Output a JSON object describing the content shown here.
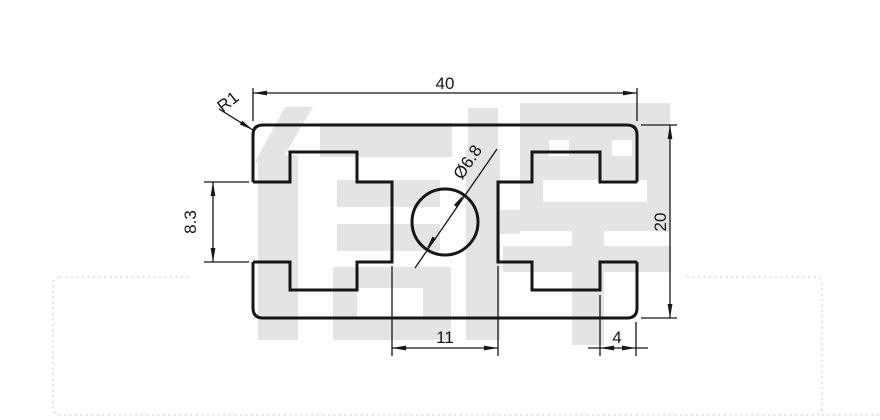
{
  "drawing": {
    "watermark_text": "信牌",
    "dimensions": {
      "overall_width": "40",
      "overall_height": "20",
      "slot_opening_height": "8.3",
      "center_web_width": "11",
      "side_wall_width": "4",
      "corner_radius": "R1",
      "hole_diameter": "Ø6.8"
    },
    "colors": {
      "line": "#161616",
      "watermark": "#e4e4e4",
      "page_dash": "#d9d9d9",
      "background": "#ffffff"
    }
  }
}
